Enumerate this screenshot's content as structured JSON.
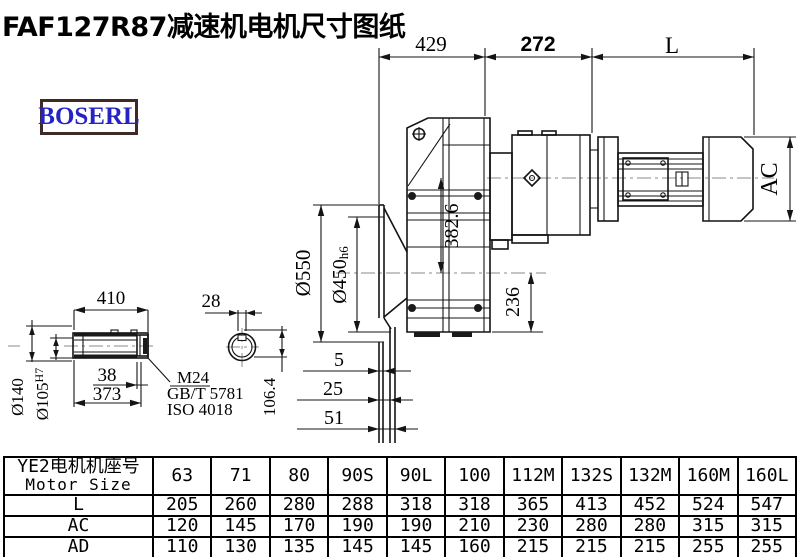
{
  "title": "FAF127R87减速机电机尺寸图纸",
  "logo": {
    "text": "BOSERL",
    "color": "#2424c4"
  },
  "drawing": {
    "d429": "429",
    "d272": "272",
    "dL": "L",
    "dAC": "AC",
    "dia550": "Ø550",
    "dia450": "Ø450",
    "dia450_tol": "h6",
    "d3826": "382.6",
    "d236": "236",
    "d5": "5",
    "d25": "25",
    "d51": "51",
    "shaft": {
      "d410": "410",
      "d28": "28",
      "dia140": "Ø140",
      "dia105": "Ø105",
      "dia105_tol": "H7",
      "d38": "38",
      "d373": "373",
      "thread": "M24",
      "std1": "GB/T 5781",
      "std2": "ISO 4018",
      "d1064": "106.4"
    }
  },
  "table": {
    "header": {
      "line1": "YE2电机机座号",
      "line2": "Motor Size"
    },
    "columns": [
      "63",
      "71",
      "80",
      "90S",
      "90L",
      "100",
      "112M",
      "132S",
      "132M",
      "160M",
      "160L"
    ],
    "rows": [
      {
        "label": "L",
        "values": [
          "205",
          "260",
          "280",
          "288",
          "318",
          "318",
          "365",
          "413",
          "452",
          "524",
          "547"
        ]
      },
      {
        "label": "AC",
        "values": [
          "120",
          "145",
          "170",
          "190",
          "190",
          "210",
          "230",
          "280",
          "280",
          "315",
          "315"
        ]
      },
      {
        "label": "AD",
        "values": [
          "110",
          "130",
          "135",
          "145",
          "145",
          "160",
          "215",
          "215",
          "215",
          "255",
          "255"
        ]
      }
    ]
  }
}
